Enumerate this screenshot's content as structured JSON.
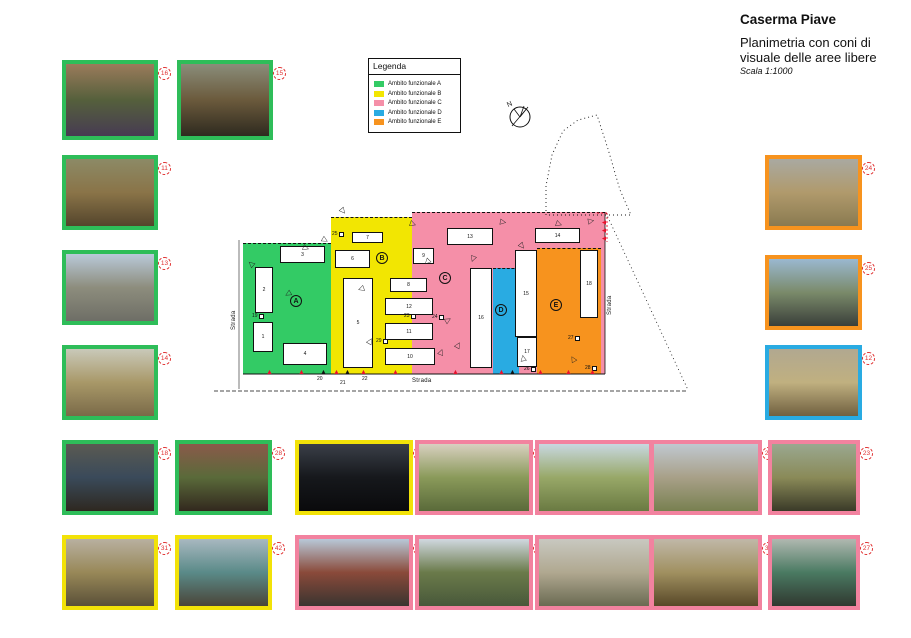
{
  "header": {
    "title": "Caserma Piave",
    "subtitle": "Planimetria con coni di visuale delle aree libere",
    "scale": "Scala 1:1000"
  },
  "legend": {
    "title": "Legenda",
    "items": [
      {
        "label": "Ambito funzionale A",
        "color": "#33CB65"
      },
      {
        "label": "Ambito funzionale B",
        "color": "#F2E602"
      },
      {
        "label": "Ambito funzionale C",
        "color": "#F58FA8"
      },
      {
        "label": "Ambito funzionale D",
        "color": "#29ABE2"
      },
      {
        "label": "Ambito funzionale E",
        "color": "#F7931E"
      }
    ]
  },
  "compass": {
    "label": "N"
  },
  "map": {
    "zones": [
      {
        "name": "zone-A",
        "x": 243,
        "y": 243,
        "w": 88,
        "h": 131,
        "color": "#33CB65"
      },
      {
        "name": "zone-B",
        "x": 331,
        "y": 217,
        "w": 81,
        "h": 157,
        "color": "#F2E602"
      },
      {
        "name": "zone-C",
        "x": 412,
        "y": 212,
        "w": 193,
        "h": 162,
        "color": "#F58FA8"
      },
      {
        "name": "zone-D",
        "x": 493,
        "y": 268,
        "w": 26,
        "h": 106,
        "color": "#29ABE2"
      },
      {
        "name": "zone-E",
        "x": 537,
        "y": 248,
        "w": 64,
        "h": 126,
        "color": "#F7931E"
      }
    ],
    "zone_letters": [
      {
        "label": "A",
        "x": 290,
        "y": 295
      },
      {
        "label": "B",
        "x": 376,
        "y": 252
      },
      {
        "label": "C",
        "x": 439,
        "y": 272
      },
      {
        "label": "D",
        "x": 495,
        "y": 304
      },
      {
        "label": "E",
        "x": 550,
        "y": 299
      }
    ],
    "buildings": [
      {
        "label": "1",
        "x": 253,
        "y": 322,
        "w": 20,
        "h": 30
      },
      {
        "label": "2",
        "x": 255,
        "y": 267,
        "w": 18,
        "h": 46
      },
      {
        "label": "3",
        "x": 280,
        "y": 246,
        "w": 45,
        "h": 17
      },
      {
        "label": "4",
        "x": 283,
        "y": 343,
        "w": 44,
        "h": 22
      },
      {
        "label": "5",
        "x": 343,
        "y": 278,
        "w": 30,
        "h": 90
      },
      {
        "label": "6",
        "x": 335,
        "y": 250,
        "w": 35,
        "h": 18
      },
      {
        "label": "7",
        "x": 352,
        "y": 232,
        "w": 31,
        "h": 11
      },
      {
        "label": "8",
        "x": 390,
        "y": 278,
        "w": 37,
        "h": 14
      },
      {
        "label": "9",
        "x": 413,
        "y": 248,
        "w": 21,
        "h": 16
      },
      {
        "label": "10",
        "x": 385,
        "y": 348,
        "w": 50,
        "h": 17
      },
      {
        "label": "11",
        "x": 385,
        "y": 323,
        "w": 48,
        "h": 17
      },
      {
        "label": "12",
        "x": 385,
        "y": 298,
        "w": 48,
        "h": 17
      },
      {
        "label": "13",
        "x": 447,
        "y": 228,
        "w": 46,
        "h": 17
      },
      {
        "label": "14",
        "x": 535,
        "y": 228,
        "w": 45,
        "h": 15
      },
      {
        "label": "15",
        "x": 515,
        "y": 250,
        "w": 22,
        "h": 87
      },
      {
        "label": "16",
        "x": 470,
        "y": 268,
        "w": 22,
        "h": 100
      },
      {
        "label": "17",
        "x": 517,
        "y": 337,
        "w": 20,
        "h": 30
      },
      {
        "label": "18",
        "x": 580,
        "y": 250,
        "w": 18,
        "h": 68
      }
    ],
    "markers": [
      {
        "label": "19",
        "x": 252,
        "y": 314
      },
      {
        "label": "23",
        "x": 404,
        "y": 314
      },
      {
        "label": "24",
        "x": 432,
        "y": 315
      },
      {
        "label": "25",
        "x": 332,
        "y": 232
      },
      {
        "label": "29",
        "x": 376,
        "y": 339
      },
      {
        "label": "26",
        "x": 524,
        "y": 367
      },
      {
        "label": "27",
        "x": 568,
        "y": 336
      },
      {
        "label": "28",
        "x": 585,
        "y": 366
      }
    ],
    "bottom_labels": [
      {
        "label": "20",
        "x": 317,
        "y": 377
      },
      {
        "label": "21",
        "x": 340,
        "y": 381
      },
      {
        "label": "22",
        "x": 362,
        "y": 377
      }
    ],
    "strada_labels": [
      {
        "label": "Strada",
        "x": 231,
        "y": 330,
        "rotate": -90
      },
      {
        "label": "Strada",
        "x": 607,
        "y": 315,
        "rotate": -90
      },
      {
        "label": "Strada",
        "x": 412,
        "y": 378,
        "rotate": 0
      }
    ],
    "cones": [
      {
        "x": 248,
        "y": 260,
        "rotate": 40
      },
      {
        "x": 285,
        "y": 290,
        "rotate": -30
      },
      {
        "x": 303,
        "y": 244,
        "rotate": 200
      },
      {
        "x": 322,
        "y": 236,
        "rotate": 210
      },
      {
        "x": 340,
        "y": 207,
        "rotate": 230
      },
      {
        "x": 367,
        "y": 337,
        "rotate": 120
      },
      {
        "x": 358,
        "y": 285,
        "rotate": -20
      },
      {
        "x": 410,
        "y": 220,
        "rotate": 200
      },
      {
        "x": 424,
        "y": 258,
        "rotate": -45
      },
      {
        "x": 445,
        "y": 316,
        "rotate": 150
      },
      {
        "x": 455,
        "y": 341,
        "rotate": 120
      },
      {
        "x": 470,
        "y": 255,
        "rotate": -70
      },
      {
        "x": 500,
        "y": 218,
        "rotate": 190
      },
      {
        "x": 519,
        "y": 242,
        "rotate": 230
      },
      {
        "x": 556,
        "y": 220,
        "rotate": 200
      },
      {
        "x": 588,
        "y": 217,
        "rotate": 170
      },
      {
        "x": 438,
        "y": 348,
        "rotate": 110
      },
      {
        "x": 520,
        "y": 354,
        "rotate": 80
      },
      {
        "x": 570,
        "y": 355,
        "rotate": 60
      }
    ],
    "triangles": [
      {
        "x": 266,
        "y": 369,
        "color": "#E8112D"
      },
      {
        "x": 298,
        "y": 369,
        "color": "#E8112D"
      },
      {
        "x": 320,
        "y": 369,
        "color": "#111111"
      },
      {
        "x": 333,
        "y": 369,
        "color": "#E8112D"
      },
      {
        "x": 344,
        "y": 369,
        "color": "#111111"
      },
      {
        "x": 360,
        "y": 369,
        "color": "#E8112D"
      },
      {
        "x": 392,
        "y": 369,
        "color": "#E8112D"
      },
      {
        "x": 452,
        "y": 369,
        "color": "#E8112D"
      },
      {
        "x": 498,
        "y": 369,
        "color": "#E8112D"
      },
      {
        "x": 509,
        "y": 369,
        "color": "#111111"
      },
      {
        "x": 537,
        "y": 369,
        "color": "#E8112D"
      },
      {
        "x": 565,
        "y": 369,
        "color": "#E8112D"
      },
      {
        "x": 589,
        "y": 369,
        "color": "#E8112D"
      },
      {
        "x": 601,
        "y": 219,
        "color": "#E8112D",
        "rotate": -90
      },
      {
        "x": 601,
        "y": 227,
        "color": "#E8112D",
        "rotate": -90
      },
      {
        "x": 601,
        "y": 235,
        "color": "#E8112D",
        "rotate": -90
      }
    ]
  },
  "photos": [
    {
      "num": "16",
      "x": 62,
      "y": 60,
      "w": 96,
      "h": 80,
      "border": "#2EBD59",
      "colors": [
        "#9b7b5b",
        "#55603c",
        "#473b52"
      ]
    },
    {
      "num": "15",
      "x": 177,
      "y": 60,
      "w": 96,
      "h": 80,
      "border": "#2EBD59",
      "colors": [
        "#8a8d7a",
        "#6b5a3c",
        "#2e2a1f"
      ]
    },
    {
      "num": "11",
      "x": 62,
      "y": 155,
      "w": 96,
      "h": 75,
      "border": "#2EBD59",
      "colors": [
        "#8c8a66",
        "#8a7448",
        "#54452c"
      ]
    },
    {
      "num": "13",
      "x": 62,
      "y": 250,
      "w": 96,
      "h": 75,
      "border": "#2EBD59",
      "colors": [
        "#b9c9d9",
        "#8d8d7d",
        "#6e6e66"
      ]
    },
    {
      "num": "14",
      "x": 62,
      "y": 345,
      "w": 96,
      "h": 75,
      "border": "#2EBD59",
      "colors": [
        "#c9c9b9",
        "#a89868",
        "#7a6a48"
      ]
    },
    {
      "num": "24",
      "x": 765,
      "y": 155,
      "w": 97,
      "h": 75,
      "border": "#F7931E",
      "colors": [
        "#a9a9a1",
        "#b09a6c",
        "#8a7a50"
      ]
    },
    {
      "num": "25",
      "x": 765,
      "y": 255,
      "w": 97,
      "h": 75,
      "border": "#F7931E",
      "colors": [
        "#9ab8d0",
        "#7a8a6a",
        "#3a3f3a"
      ]
    },
    {
      "num": "12",
      "x": 765,
      "y": 345,
      "w": 97,
      "h": 75,
      "border": "#29ABE2",
      "colors": [
        "#b1a890",
        "#c0b080",
        "#706040"
      ]
    },
    {
      "num": "18",
      "x": 62,
      "y": 440,
      "w": 96,
      "h": 75,
      "border": "#2EBD59",
      "colors": [
        "#5a5a52",
        "#3a4a5a",
        "#2e2820"
      ]
    },
    {
      "num": "28",
      "x": 175,
      "y": 440,
      "w": 97,
      "h": 75,
      "border": "#2EBD59",
      "colors": [
        "#8a5a4a",
        "#5a6a3a",
        "#32281e"
      ]
    },
    {
      "num": "26",
      "x": 295,
      "y": 440,
      "w": 118,
      "h": 75,
      "border": "#F2E208",
      "colors": [
        "#3a3f48",
        "#16181c",
        "#0a0a0c"
      ]
    },
    {
      "num": "33",
      "x": 415,
      "y": 440,
      "w": 118,
      "h": 75,
      "border": "#F2829F",
      "colors": [
        "#d8d0c0",
        "#8a9a5a",
        "#5a6a3a"
      ]
    },
    {
      "num": "38",
      "x": 535,
      "y": 440,
      "w": 118,
      "h": 75,
      "border": "#F2829F",
      "colors": [
        "#c8d8e0",
        "#98a868",
        "#6a7a42"
      ]
    },
    {
      "num": "29",
      "x": 650,
      "y": 440,
      "w": 112,
      "h": 75,
      "border": "#F2829F",
      "colors": [
        "#c0c8d0",
        "#a8a088",
        "#788050"
      ]
    },
    {
      "num": "23",
      "x": 768,
      "y": 440,
      "w": 92,
      "h": 75,
      "border": "#F2829F",
      "colors": [
        "#9aa890",
        "#8a8a58",
        "#3a3a28"
      ]
    },
    {
      "num": "31",
      "x": 62,
      "y": 535,
      "w": 96,
      "h": 75,
      "border": "#F2E208",
      "colors": [
        "#b8b0a0",
        "#988858",
        "#5a5038"
      ]
    },
    {
      "num": "42",
      "x": 175,
      "y": 535,
      "w": 97,
      "h": 75,
      "border": "#F2E208",
      "colors": [
        "#a8b8c0",
        "#5a8a88",
        "#4a4438"
      ]
    },
    {
      "num": "30",
      "x": 295,
      "y": 535,
      "w": 118,
      "h": 75,
      "border": "#F2829F",
      "colors": [
        "#b8c8d8",
        "#8a4a3a",
        "#3a3430"
      ]
    },
    {
      "num": "41",
      "x": 415,
      "y": 535,
      "w": 118,
      "h": 75,
      "border": "#F2829F",
      "colors": [
        "#d0d8e0",
        "#6a7a4a",
        "#48583a"
      ]
    },
    {
      "num": "34",
      "x": 535,
      "y": 535,
      "w": 118,
      "h": 75,
      "border": "#F2829F",
      "colors": [
        "#c8c8c0",
        "#b0a890",
        "#6a6a52"
      ]
    },
    {
      "num": "35",
      "x": 650,
      "y": 535,
      "w": 112,
      "h": 75,
      "border": "#F2829F",
      "colors": [
        "#c0b8a8",
        "#a09060",
        "#584828"
      ]
    },
    {
      "num": "27",
      "x": 768,
      "y": 535,
      "w": 92,
      "h": 75,
      "border": "#F2829F",
      "colors": [
        "#b0b8b0",
        "#4a7a62",
        "#303830"
      ]
    }
  ]
}
